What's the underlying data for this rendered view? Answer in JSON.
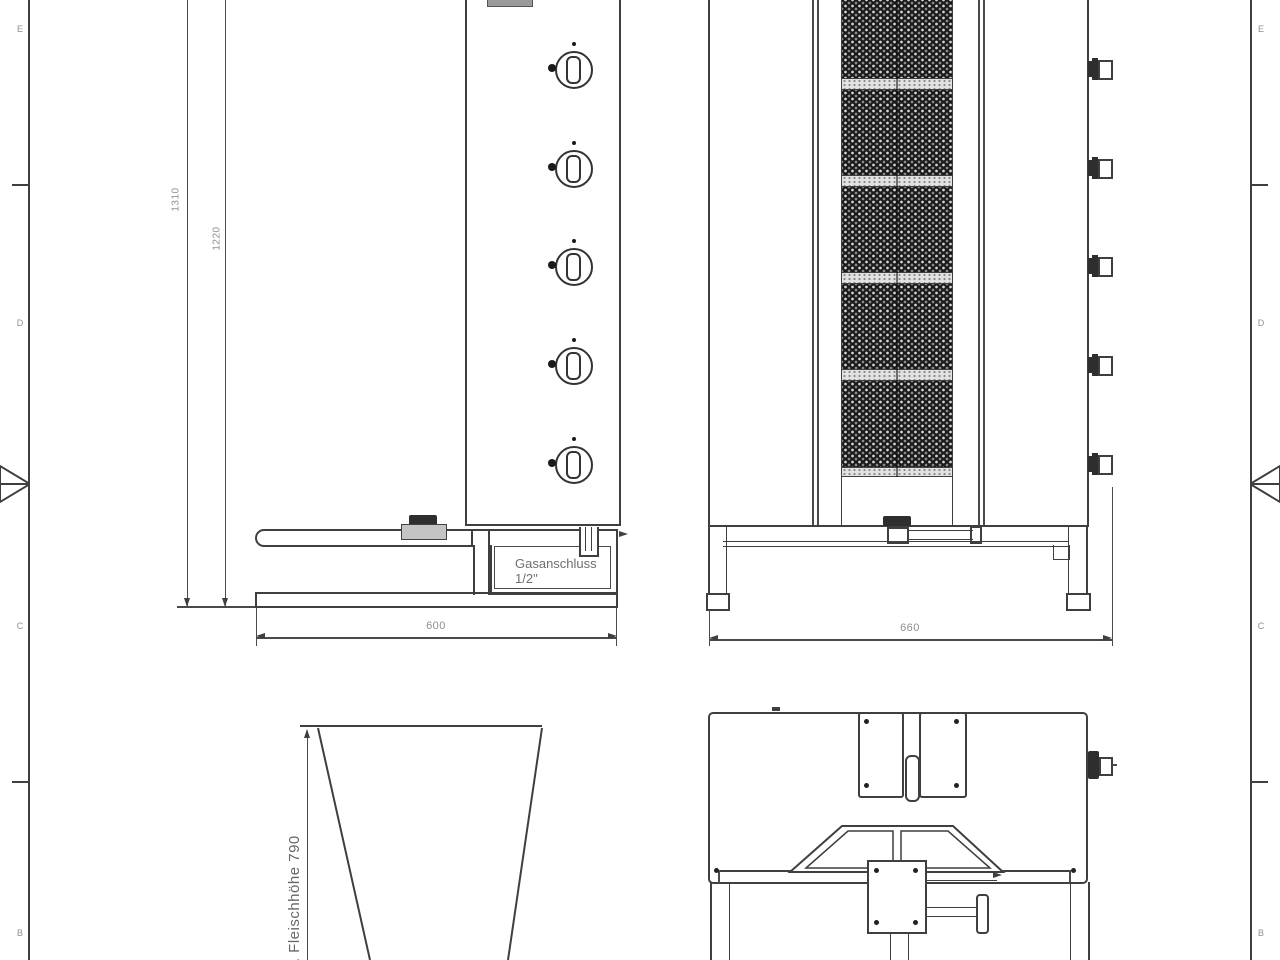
{
  "frame": {
    "left_labels": [
      "E",
      "D",
      "C",
      "B"
    ],
    "right_labels": [
      "E",
      "D",
      "C",
      "B"
    ]
  },
  "side_view": {
    "overall_height": "1310",
    "upper_height": "1220",
    "base_width": "600",
    "gas_line1": "Gasanschluss",
    "gas_line2": "1/2\""
  },
  "front_view": {
    "base_width": "660"
  },
  "cone_view": {
    "height_label": "max. Fleischhöhe 790"
  },
  "colors": {
    "line": "#3f3f3f",
    "dim_text": "#8f8f8f",
    "annotation_text": "#6f6f6f",
    "burner_dark": "#1b1b1b",
    "burner_band": "#e2e2e2"
  }
}
